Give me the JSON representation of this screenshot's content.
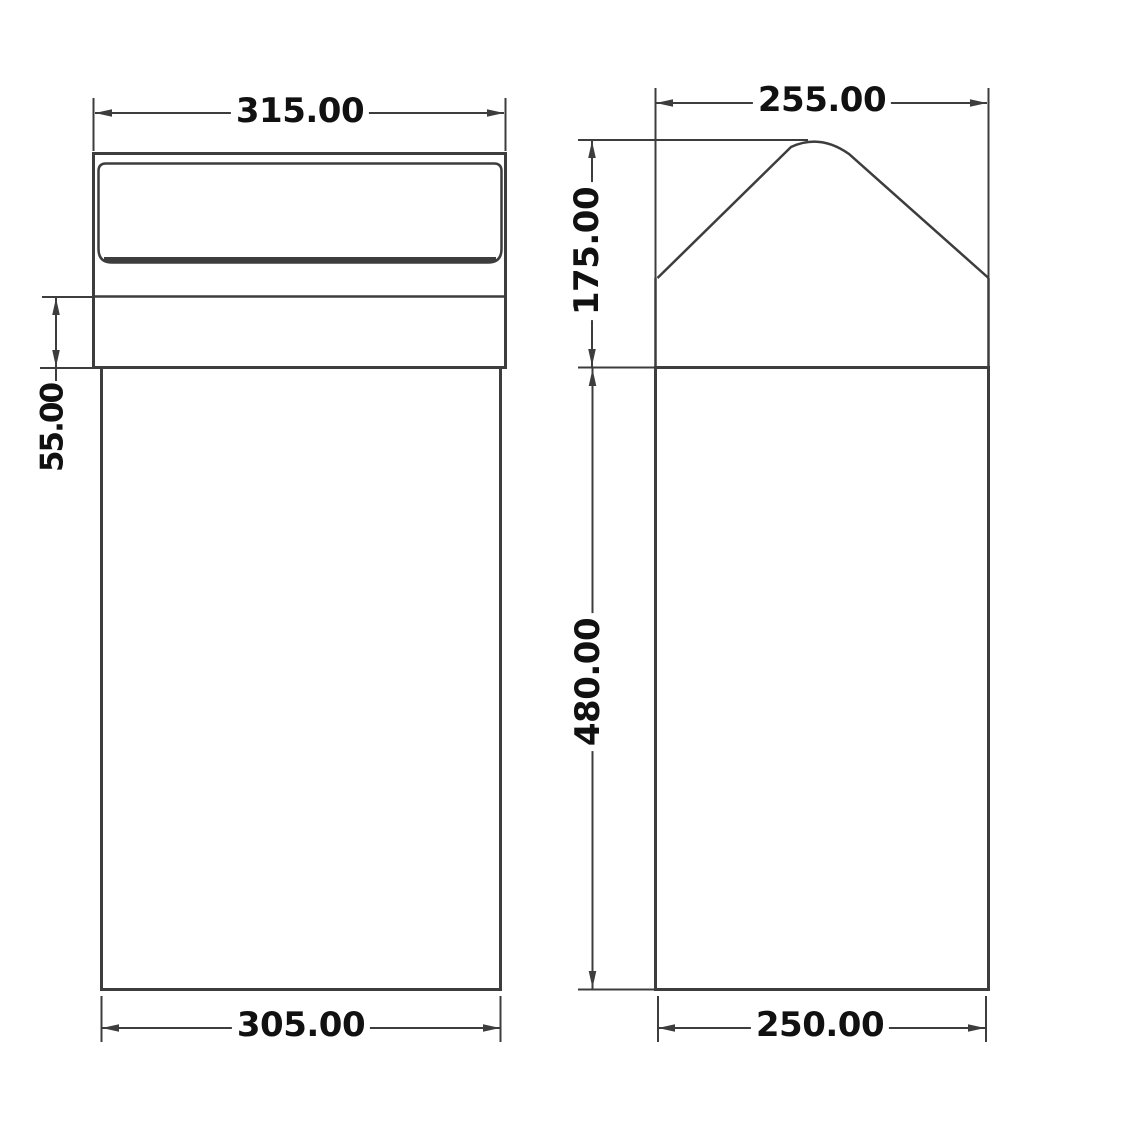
{
  "drawing": {
    "front_view": {
      "dim_top_width": "315.00",
      "dim_band_height": "55.00",
      "dim_bottom_width": "305.00"
    },
    "side_view": {
      "dim_top_width": "255.00",
      "dim_hood_height": "175.00",
      "dim_body_height": "480.00",
      "dim_bottom_width": "250.00"
    },
    "colors": {
      "line": "#3d3d3d",
      "text": "#111111",
      "background": "#ffffff"
    }
  }
}
